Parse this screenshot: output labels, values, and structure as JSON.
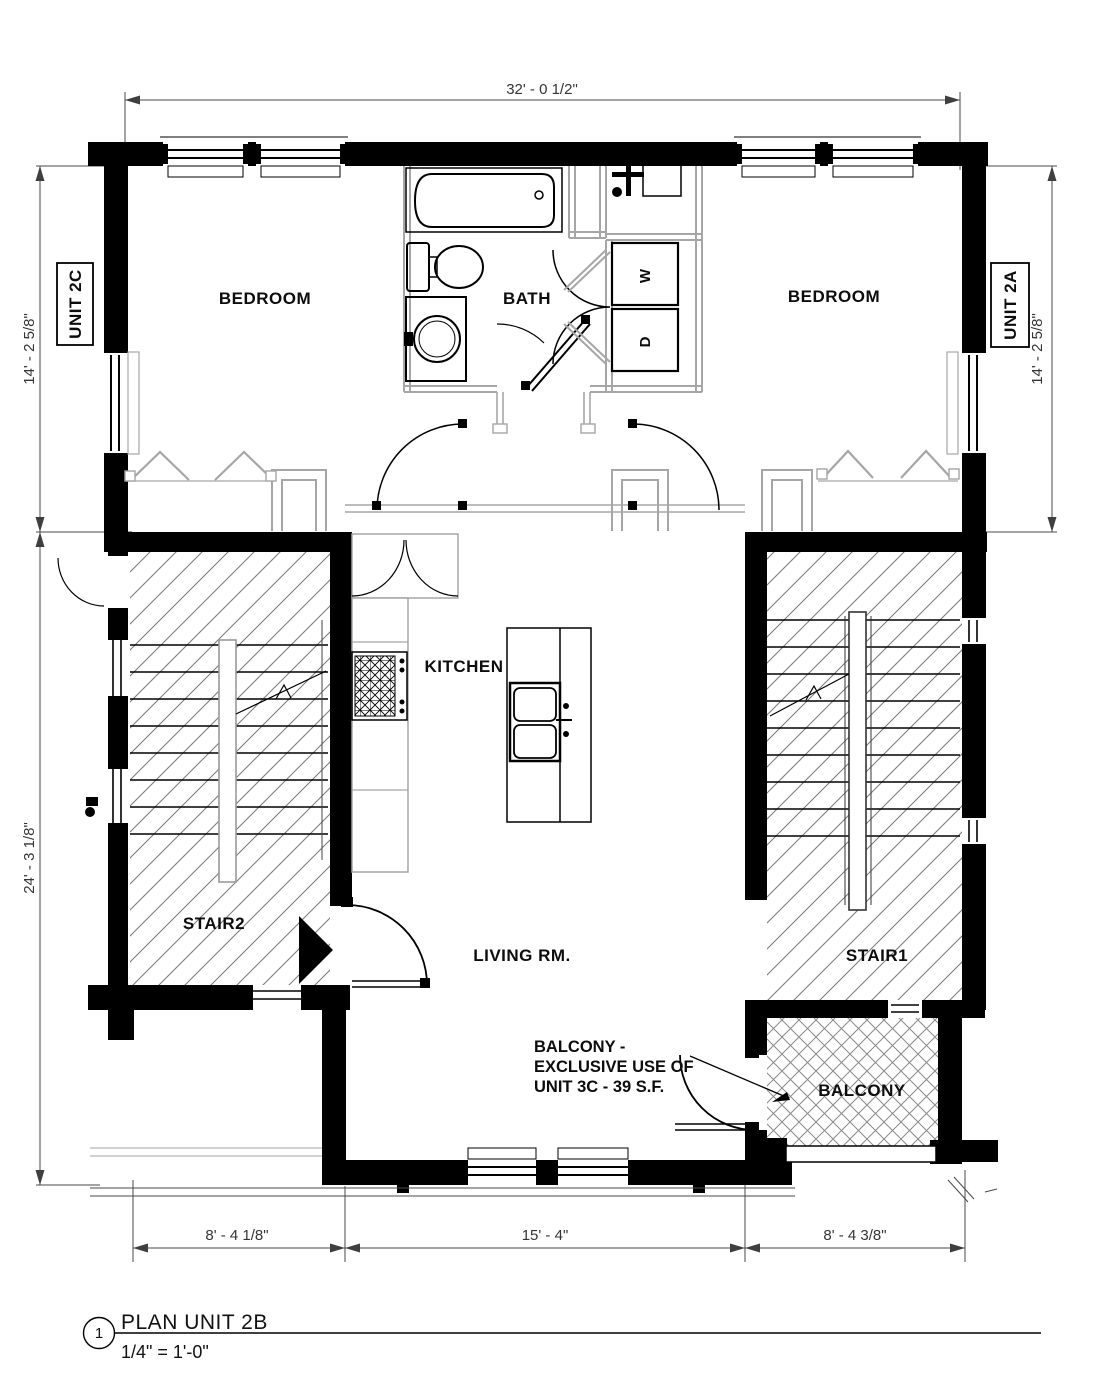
{
  "drawing": {
    "detail_number": "1",
    "title": "PLAN UNIT 2B",
    "scale": "1/4\" = 1'-0\""
  },
  "unit_tags": {
    "left": "UNIT 2C",
    "right": "UNIT 2A"
  },
  "rooms": {
    "bedroom_left": "BEDROOM",
    "bath": "BATH",
    "bedroom_right": "BEDROOM",
    "kitchen": "KITCHEN",
    "living_room": "LIVING RM.",
    "stair_1": "STAIR1",
    "stair_2": "STAIR2",
    "balcony": "BALCONY"
  },
  "appliances": {
    "washer": "W",
    "dryer": "D"
  },
  "dimensions": {
    "top_width": "32' - 0 1/2\"",
    "left_upper": "14' - 2 5/8\"",
    "left_lower": "24' - 3 1/8\"",
    "right_upper": "14' - 2 5/8\"",
    "bottom_left": "8' - 4 1/8\"",
    "bottom_center": "15' - 4\"",
    "bottom_right": "8' - 4 3/8\""
  },
  "balcony_note": {
    "line1": "BALCONY -",
    "line2": "EXCLUSIVE USE OF",
    "line3": "UNIT 3C - 39 S.F."
  },
  "colors": {
    "wall": "#000000",
    "partition": "#a6a6a6",
    "hatch": "#7d7d7d",
    "dimension": "#3f3f3f",
    "background": "#ffffff"
  }
}
